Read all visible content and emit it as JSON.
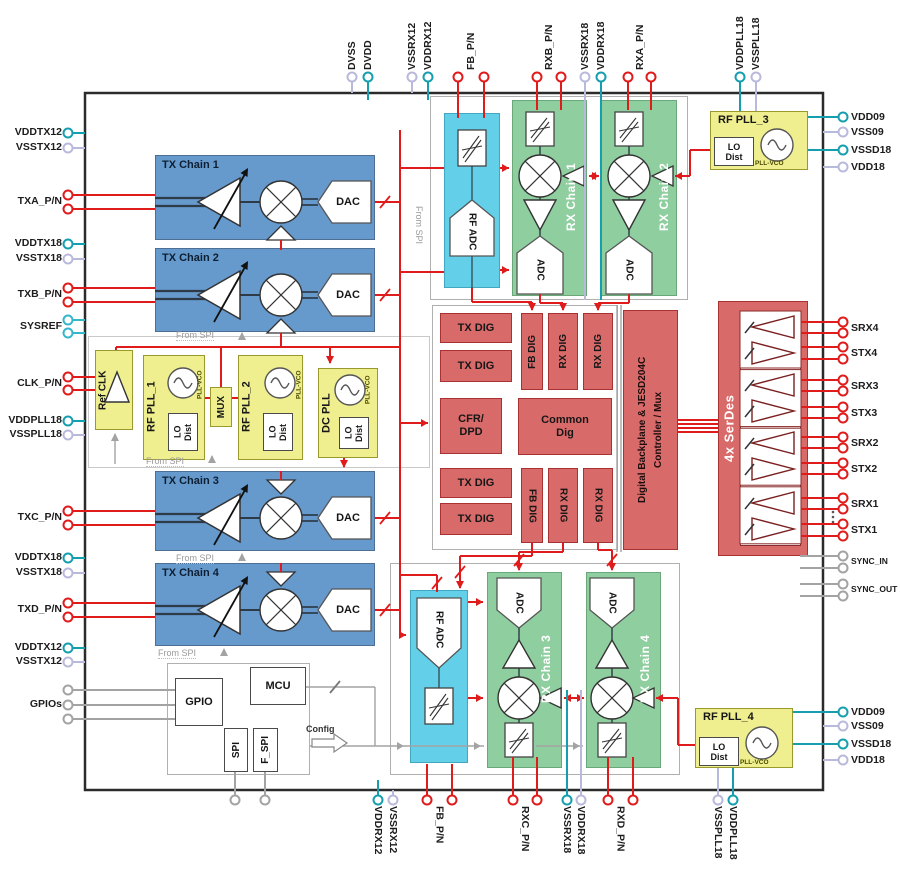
{
  "colors": {
    "tx_blue": "#6699CC",
    "rx_green": "#8FCE9F",
    "adc_cyan": "#63CFE8",
    "pll_yellow": "#EFEF8F",
    "dig_red": "#D96A6A",
    "wire_red": "#E01B1B",
    "pin_teal": "#159FAE",
    "pin_lavender": "#B9B9DC",
    "wire_gray": "#A3A3A3"
  },
  "blocks": {
    "tx1": "TX Chain 1",
    "tx2": "TX Chain 2",
    "tx3": "TX Chain 3",
    "tx4": "TX Chain 4",
    "rx1": "RX Chain 1",
    "rx2": "RX Chain 2",
    "rx3": "RX Chain 3",
    "rx4": "RX Chain 4",
    "rf_adc": "RF ADC",
    "adc": "ADC",
    "dac": "DAC",
    "tx_dig": "TX DIG",
    "fb_dig": "FB DIG",
    "rx_dig": "RX DIG",
    "cfr": "CFR/\nDPD",
    "common": "Common\nDig",
    "backplane": "Digital Backplane & JESD204C\nController / Mux",
    "serdes": "4x SerDes",
    "ref_clk": "Ref CLK",
    "pll1": "RF PLL_1",
    "pll2": "RF PLL_2",
    "pll3": "RF PLL_3",
    "pll4": "RF PLL_4",
    "dc_pll": "DC PLL",
    "mux": "MUX",
    "lo_dist": "LO\nDist",
    "pll_vco": "PLL-VCO",
    "gpio": "GPIO",
    "mcu": "MCU",
    "spi": "SPI",
    "f_spi": "F_SPI",
    "config": "Config",
    "from_spi": "From SPI"
  },
  "pins": {
    "top": [
      {
        "label": "DVSS",
        "color": "vss",
        "x": 352
      },
      {
        "label": "DVDD",
        "color": "vdd",
        "x": 368,
        "to": 100
      },
      {
        "label": "VSSRX12",
        "color": "vss",
        "x": 412
      },
      {
        "label": "VDDRX12",
        "color": "vdd",
        "x": 428,
        "to": 100
      },
      {
        "label": "FB_P/N",
        "color": "rf",
        "x": [
          458,
          484
        ],
        "to": 118
      },
      {
        "label": "RXB_P/N",
        "color": "rf",
        "x": [
          537,
          561
        ],
        "to": 110
      },
      {
        "label": "VSSRX18",
        "color": "vss",
        "x": 585,
        "to": 300
      },
      {
        "label": "VDDRX18",
        "color": "vdd",
        "x": 601,
        "to": 300
      },
      {
        "label": "RXA_P/N",
        "color": "rf",
        "x": [
          628,
          651
        ],
        "to": 110
      },
      {
        "label": "VDDPLL18",
        "color": "vdd",
        "x": 740,
        "to": 111
      },
      {
        "label": "VSSPLL18",
        "color": "vss",
        "x": 756,
        "to": 111
      }
    ],
    "bottom": [
      {
        "label": "VDDRX12",
        "color": "vdd",
        "x": 378,
        "to": 780
      },
      {
        "label": "VSSRX12",
        "color": "vss",
        "x": 393
      },
      {
        "label": "FB_P/N",
        "color": "rf",
        "x": [
          427,
          452
        ],
        "to": 764
      },
      {
        "label": "RXC_P/N",
        "color": "rf",
        "x": [
          513,
          537
        ],
        "to": 757
      },
      {
        "label": "VSSRX18",
        "color": "vdd",
        "x": 567,
        "to": 690
      },
      {
        "label": "VDDRX18",
        "color": "vss",
        "x": 581,
        "to": 690
      },
      {
        "label": "RXD_P/N",
        "color": "rf",
        "x": [
          608,
          633
        ],
        "to": 757
      },
      {
        "label": "VSSPLL18",
        "color": "vss",
        "x": 718,
        "to": 768
      },
      {
        "label": "VDDPLL18",
        "color": "vdd",
        "x": 733,
        "to": 768
      },
      {
        "label": "",
        "color": "gray",
        "x": 235,
        "to": 772
      },
      {
        "label": "",
        "color": "gray",
        "x": 265,
        "to": 772
      }
    ],
    "left": [
      {
        "label": "VDDTX12",
        "color": "vdd",
        "y": 133
      },
      {
        "label": "VSSTX12",
        "color": "vss",
        "y": 148
      },
      {
        "label": "TXA_P/N",
        "color": "rf",
        "y": [
          195,
          209
        ],
        "to": 155
      },
      {
        "label": "VDDTX18",
        "color": "vdd",
        "y": 244
      },
      {
        "label": "VSSTX18",
        "color": "vss",
        "y": 259
      },
      {
        "label": "TXB_P/N",
        "color": "rf",
        "y": [
          288,
          302
        ],
        "to": 155
      },
      {
        "label": "SYSREF",
        "color": "sysref",
        "y": [
          320,
          333
        ]
      },
      {
        "label": "CLK_P/N",
        "color": "rf",
        "y": [
          377,
          390
        ],
        "to": 95
      },
      {
        "label": "VDDPLL18",
        "color": "vdd",
        "y": 421
      },
      {
        "label": "VSSPLL18",
        "color": "vss",
        "y": 435
      },
      {
        "label": "TXC_P/N",
        "color": "rf",
        "y": [
          511,
          525
        ],
        "to": 155
      },
      {
        "label": "VDDTX18",
        "color": "vdd",
        "y": 558
      },
      {
        "label": "VSSTX18",
        "color": "vss",
        "y": 573
      },
      {
        "label": "TXD_P/N",
        "color": "rf",
        "y": [
          603,
          617
        ],
        "to": 155
      },
      {
        "label": "VDDTX12",
        "color": "vdd",
        "y": 648
      },
      {
        "label": "VSSTX12",
        "color": "vss",
        "y": 662
      },
      {
        "label": "GPIOs",
        "color": "gray",
        "y": [
          690,
          705,
          719
        ],
        "to": 175
      }
    ],
    "right": [
      {
        "label": "VDD09",
        "color": "vdd",
        "y": 117,
        "to": 808
      },
      {
        "label": "VSS09",
        "color": "vss",
        "y": 132
      },
      {
        "label": "VSSD18",
        "color": "vdd",
        "y": 150,
        "to": 808
      },
      {
        "label": "VDD18",
        "color": "vss",
        "y": 167
      },
      {
        "label": "SRX4",
        "color": "rf",
        "y": [
          322,
          333
        ],
        "to": 801
      },
      {
        "label": "STX4",
        "color": "rf",
        "y": [
          347,
          359
        ],
        "to": 801
      },
      {
        "label": "SRX3",
        "color": "rf",
        "y": [
          380,
          391
        ],
        "to": 801
      },
      {
        "label": "STX3",
        "color": "rf",
        "y": [
          407,
          418
        ],
        "to": 801
      },
      {
        "label": "SRX2",
        "color": "rf",
        "y": [
          437,
          448
        ],
        "to": 801
      },
      {
        "label": "STX2",
        "color": "rf",
        "y": [
          463,
          474
        ],
        "to": 801
      },
      {
        "label": "SRX1",
        "color": "rf",
        "y": [
          498,
          509
        ],
        "to": 801
      },
      {
        "label": "STX1",
        "color": "rf",
        "y": [
          524,
          536
        ],
        "to": 801
      },
      {
        "label": "SYNC_IN",
        "color": "gray",
        "y": [
          556,
          568
        ],
        "to": 800,
        "small": true
      },
      {
        "label": "SYNC_OUT",
        "color": "gray",
        "y": [
          584,
          596
        ],
        "to": 800,
        "small": true
      },
      {
        "label": "VDD09",
        "color": "vdd",
        "y": 712,
        "to": 793
      },
      {
        "label": "VSS09",
        "color": "vss",
        "y": 726
      },
      {
        "label": "VSSD18",
        "color": "vdd",
        "y": 744,
        "to": 793
      },
      {
        "label": "VDD18",
        "color": "vss",
        "y": 760
      }
    ]
  }
}
